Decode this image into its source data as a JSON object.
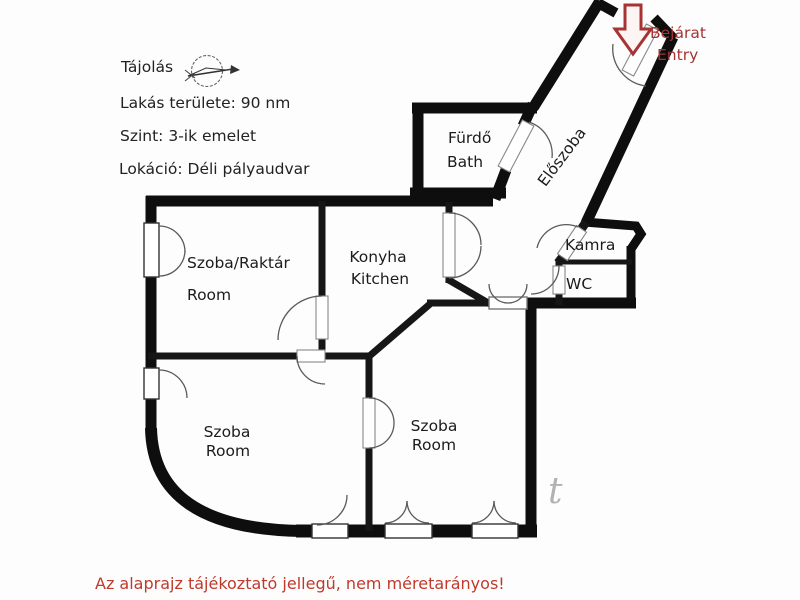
{
  "info": {
    "orientation_label": "Tájolás",
    "area_label": "Lakás területe: 90 nm",
    "floor_label": "Szint: 3-ik emelet",
    "location_label": "Lokáció: Déli pályaudvar"
  },
  "entry": {
    "line1": "Bejárat",
    "line2": "Entry"
  },
  "rooms": {
    "bath": {
      "line1": "Fürdő",
      "line2": "Bath"
    },
    "hallway": {
      "label": "Előszoba"
    },
    "pantry": {
      "label": "Kamra"
    },
    "wc": {
      "label": "WC"
    },
    "storage": {
      "line1": "Szoba/Raktár",
      "line2": "Room"
    },
    "kitchen": {
      "line1": "Konyha",
      "line2": "Kitchen"
    },
    "room_left": {
      "line1": "Szoba",
      "line2": "Room"
    },
    "room_right": {
      "line1": "Szoba",
      "line2": "Room"
    }
  },
  "disclaimer": "Az alaprajz tájékoztató jellegű, nem méretarányos!",
  "watermark": "t",
  "colors": {
    "wall": "#0e0e0e",
    "accent_red": "#a63434",
    "disclaimer_red": "#c0392b",
    "arc_gray": "#5a5a5a"
  }
}
